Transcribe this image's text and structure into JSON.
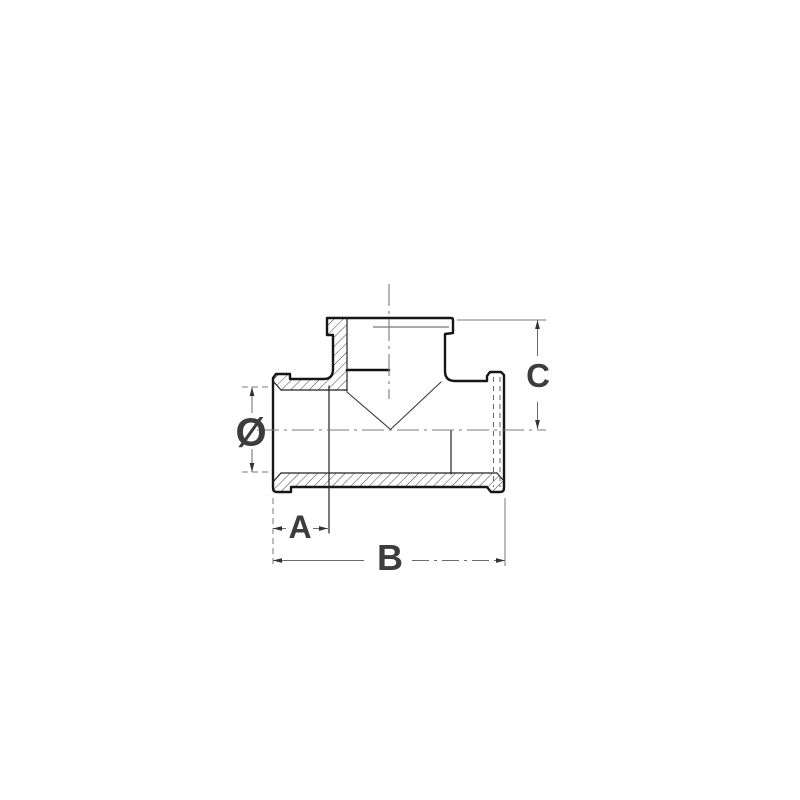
{
  "page": {
    "background": "#ffffff"
  },
  "drawing": {
    "type": "technical-dimension-diagram",
    "subject": "threaded tee pipe fitting, half-section elevation view",
    "colors": {
      "outline": "#161616",
      "dimension_lines": "#6b6b6b",
      "label_text": "#3d3d3d",
      "background": "#ffffff"
    },
    "labels": {
      "diameter": "Ø",
      "a": "A",
      "b": "B",
      "c": "C"
    }
  }
}
